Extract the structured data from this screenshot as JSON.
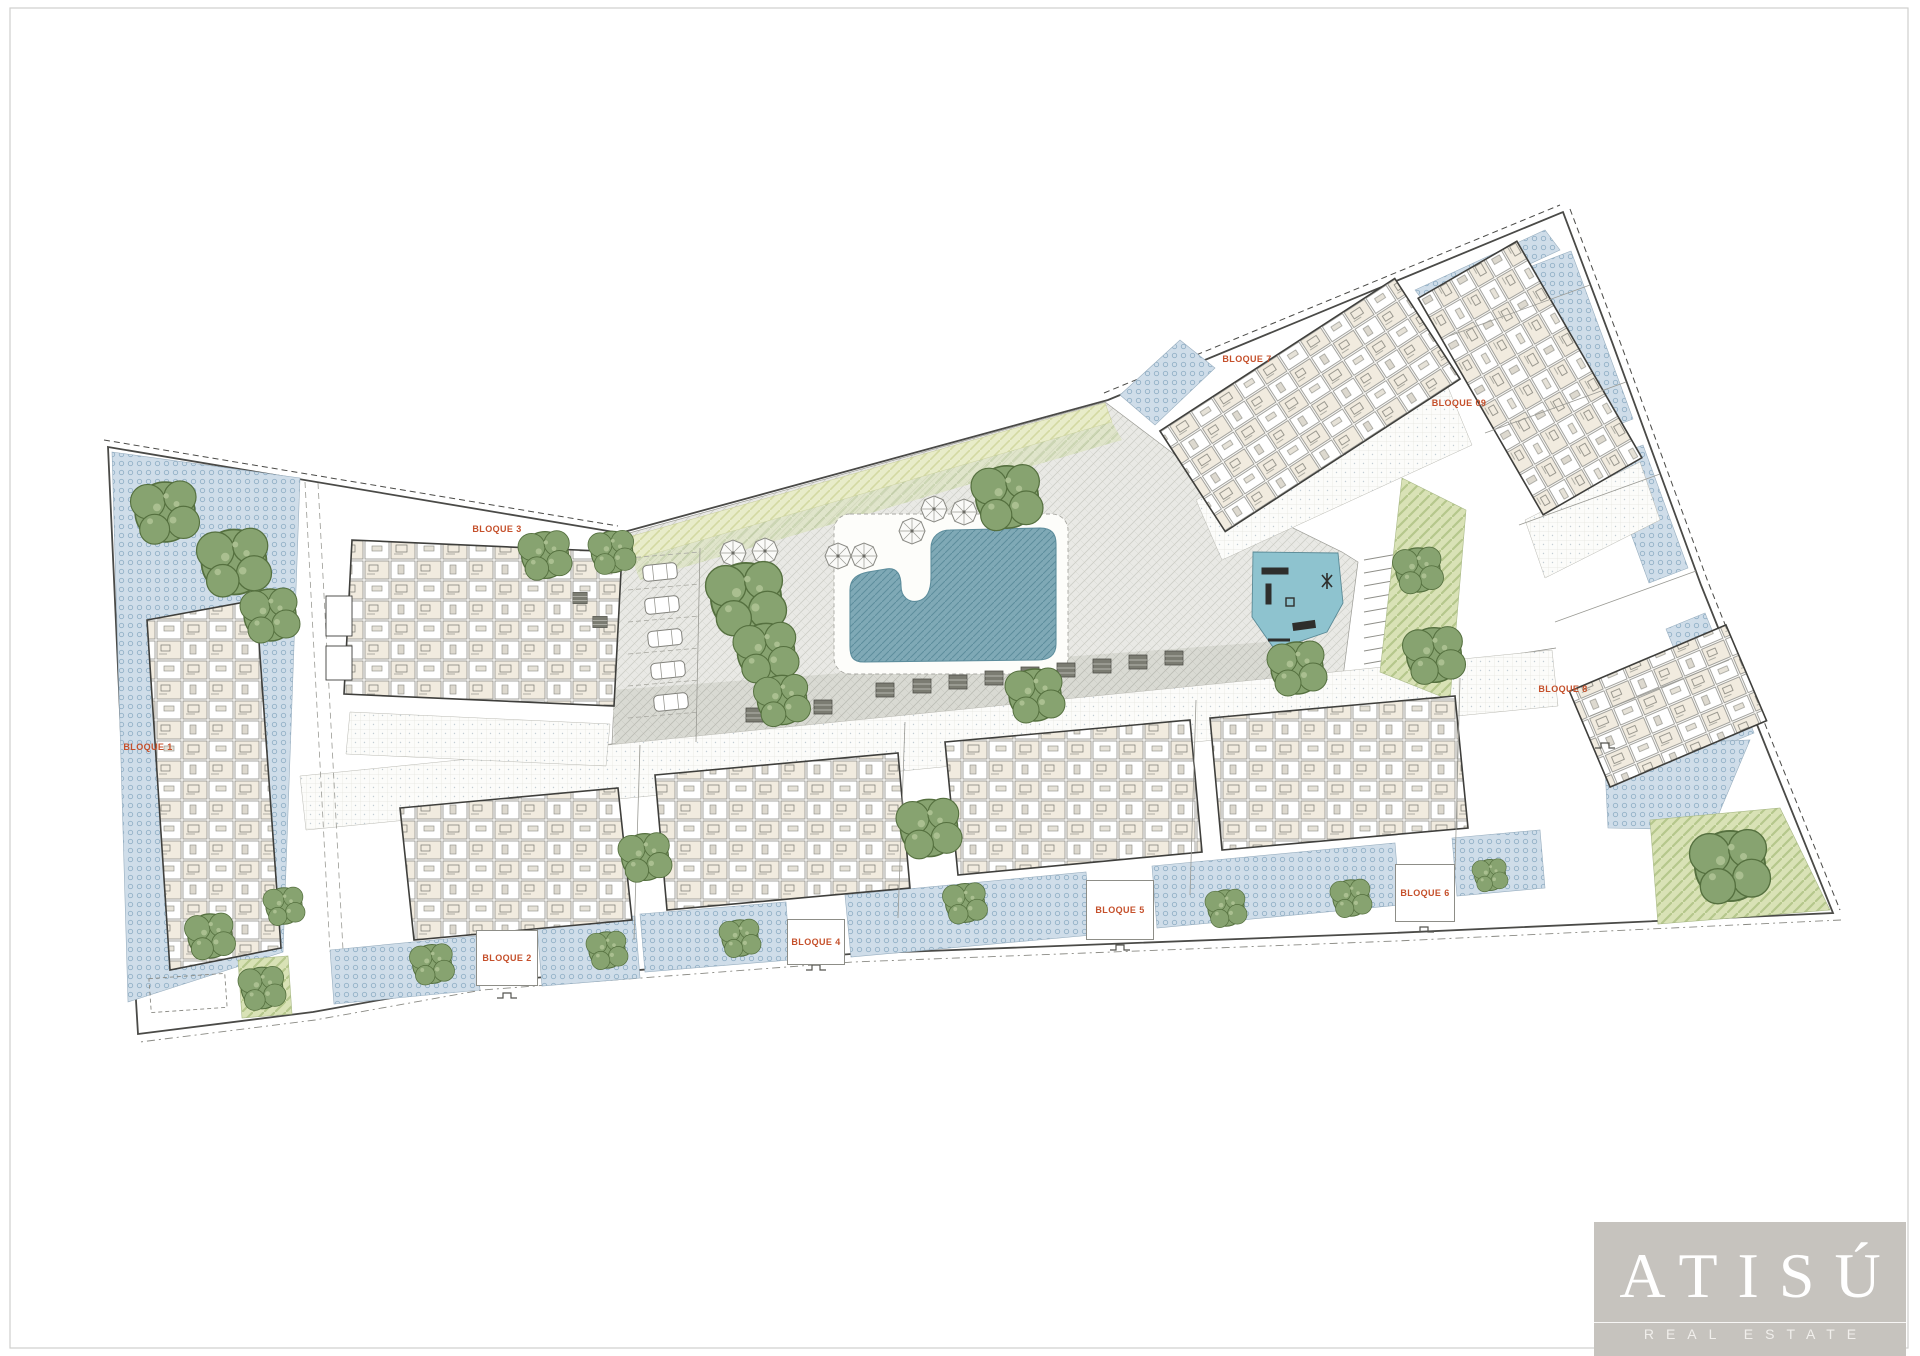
{
  "page": {
    "frame_color": "#cfcfcd",
    "background": "#ffffff"
  },
  "plan": {
    "title": "Residential development ground-floor site plan",
    "block_labels": [
      {
        "id": "bloque-1",
        "label": "BLOQUE 1",
        "x": 148,
        "y": 747,
        "box": null
      },
      {
        "id": "bloque-2",
        "label": "BLOQUE 2",
        "x": 507,
        "y": 958,
        "box": [
          476,
          930,
          62,
          56
        ]
      },
      {
        "id": "bloque-3",
        "label": "BLOQUE 3",
        "x": 497,
        "y": 529,
        "box": null
      },
      {
        "id": "bloque-4",
        "label": "BLOQUE 4",
        "x": 816,
        "y": 941,
        "box": [
          787,
          919,
          58,
          46
        ]
      },
      {
        "id": "bloque-5",
        "label": "BLOQUE 5",
        "x": 1120,
        "y": 909,
        "box": [
          1086,
          880,
          68,
          60
        ]
      },
      {
        "id": "bloque-6",
        "label": "BLOQUE 6",
        "x": 1425,
        "y": 893,
        "box": [
          1395,
          864,
          60,
          58
        ]
      },
      {
        "id": "bloque-7",
        "label": "BLOQUE 7",
        "x": 1247,
        "y": 359,
        "box": null
      },
      {
        "id": "bloque-8",
        "label": "BLOQUE 8",
        "x": 1563,
        "y": 689,
        "box": null
      },
      {
        "id": "bloque-09",
        "label": "BLOQUE 09",
        "x": 1459,
        "y": 403,
        "box": null
      }
    ],
    "colors": {
      "garden_bg": "#cfdde9",
      "garden_dot": "#93b1c7",
      "pool": "#7fa9b6",
      "pool_line": "#5d8d9c",
      "playground": "#8ec3cf",
      "lawn_bg": "#d9e2b6",
      "lawn_stripe": "#b5c78c",
      "lawn_pale_bg": "#e8ecc9",
      "lawn_pale_stripe": "#d3d9a2",
      "pave_bg": "#e9e9e5",
      "pave_line": "#cdcec7",
      "pave_dark_bg": "#d9dad3",
      "pave_dark_line": "#bcbdb5",
      "tree": "#87a370",
      "tree_line": "#55703f",
      "bldg_bg": "#fbfaf7",
      "bldg_room": "#f1ebdf",
      "bldg_line": "#8f8f8a",
      "outline": "#4a4a47",
      "label": "#c5502b",
      "frame": "#cfcfcd",
      "terrace_line": "#e4e4de"
    }
  },
  "logo": {
    "name": "ATISÚ",
    "tagline": "REAL ESTATE",
    "bg": "#c6c3be",
    "fg": "#ffffff"
  }
}
